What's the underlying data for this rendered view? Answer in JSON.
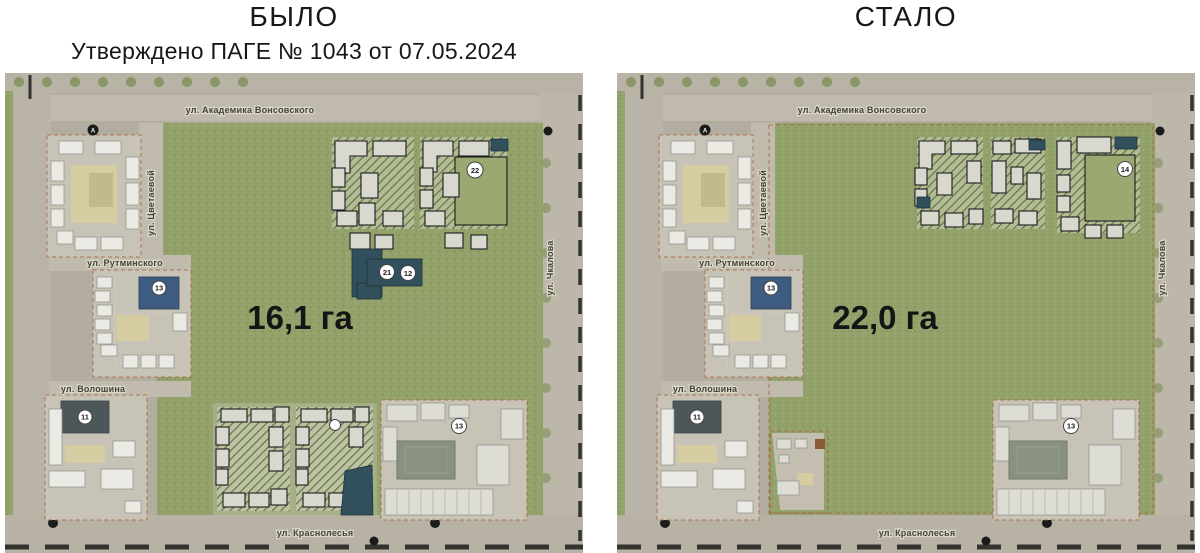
{
  "titles": {
    "left": "БЫЛО",
    "left_subtitle": "Утверждено ПАГЕ № 1043 от 07.05.2024",
    "right": "СТАЛО"
  },
  "streets": {
    "top": "ул. Академика Вонсовского",
    "left_vertical": "ул. Цветаевой",
    "mid_left": "ул. Рутминского",
    "lower_left": "ул. Волошина",
    "right_vertical": "ул. Чкалова",
    "bottom": "ул. Краснолесья"
  },
  "before": {
    "area": "16,1 га",
    "markers": {
      "plot_topright": "22",
      "school_new_a": "21",
      "school_new_b": "12",
      "mid_block": "13",
      "south_block": "11",
      "school_existing": "13"
    },
    "roundabout": "А"
  },
  "after": {
    "area": "22,0 га",
    "markers": {
      "plot_topright": "14",
      "mid_block": "13",
      "south_block": "11",
      "school_existing": "13"
    },
    "roundabout": "А"
  },
  "colors": {
    "greenery": "#93a26b",
    "planned_teal": "#31505c",
    "boundary_red": "#a8643c",
    "blue_building": "#3e5c80"
  }
}
